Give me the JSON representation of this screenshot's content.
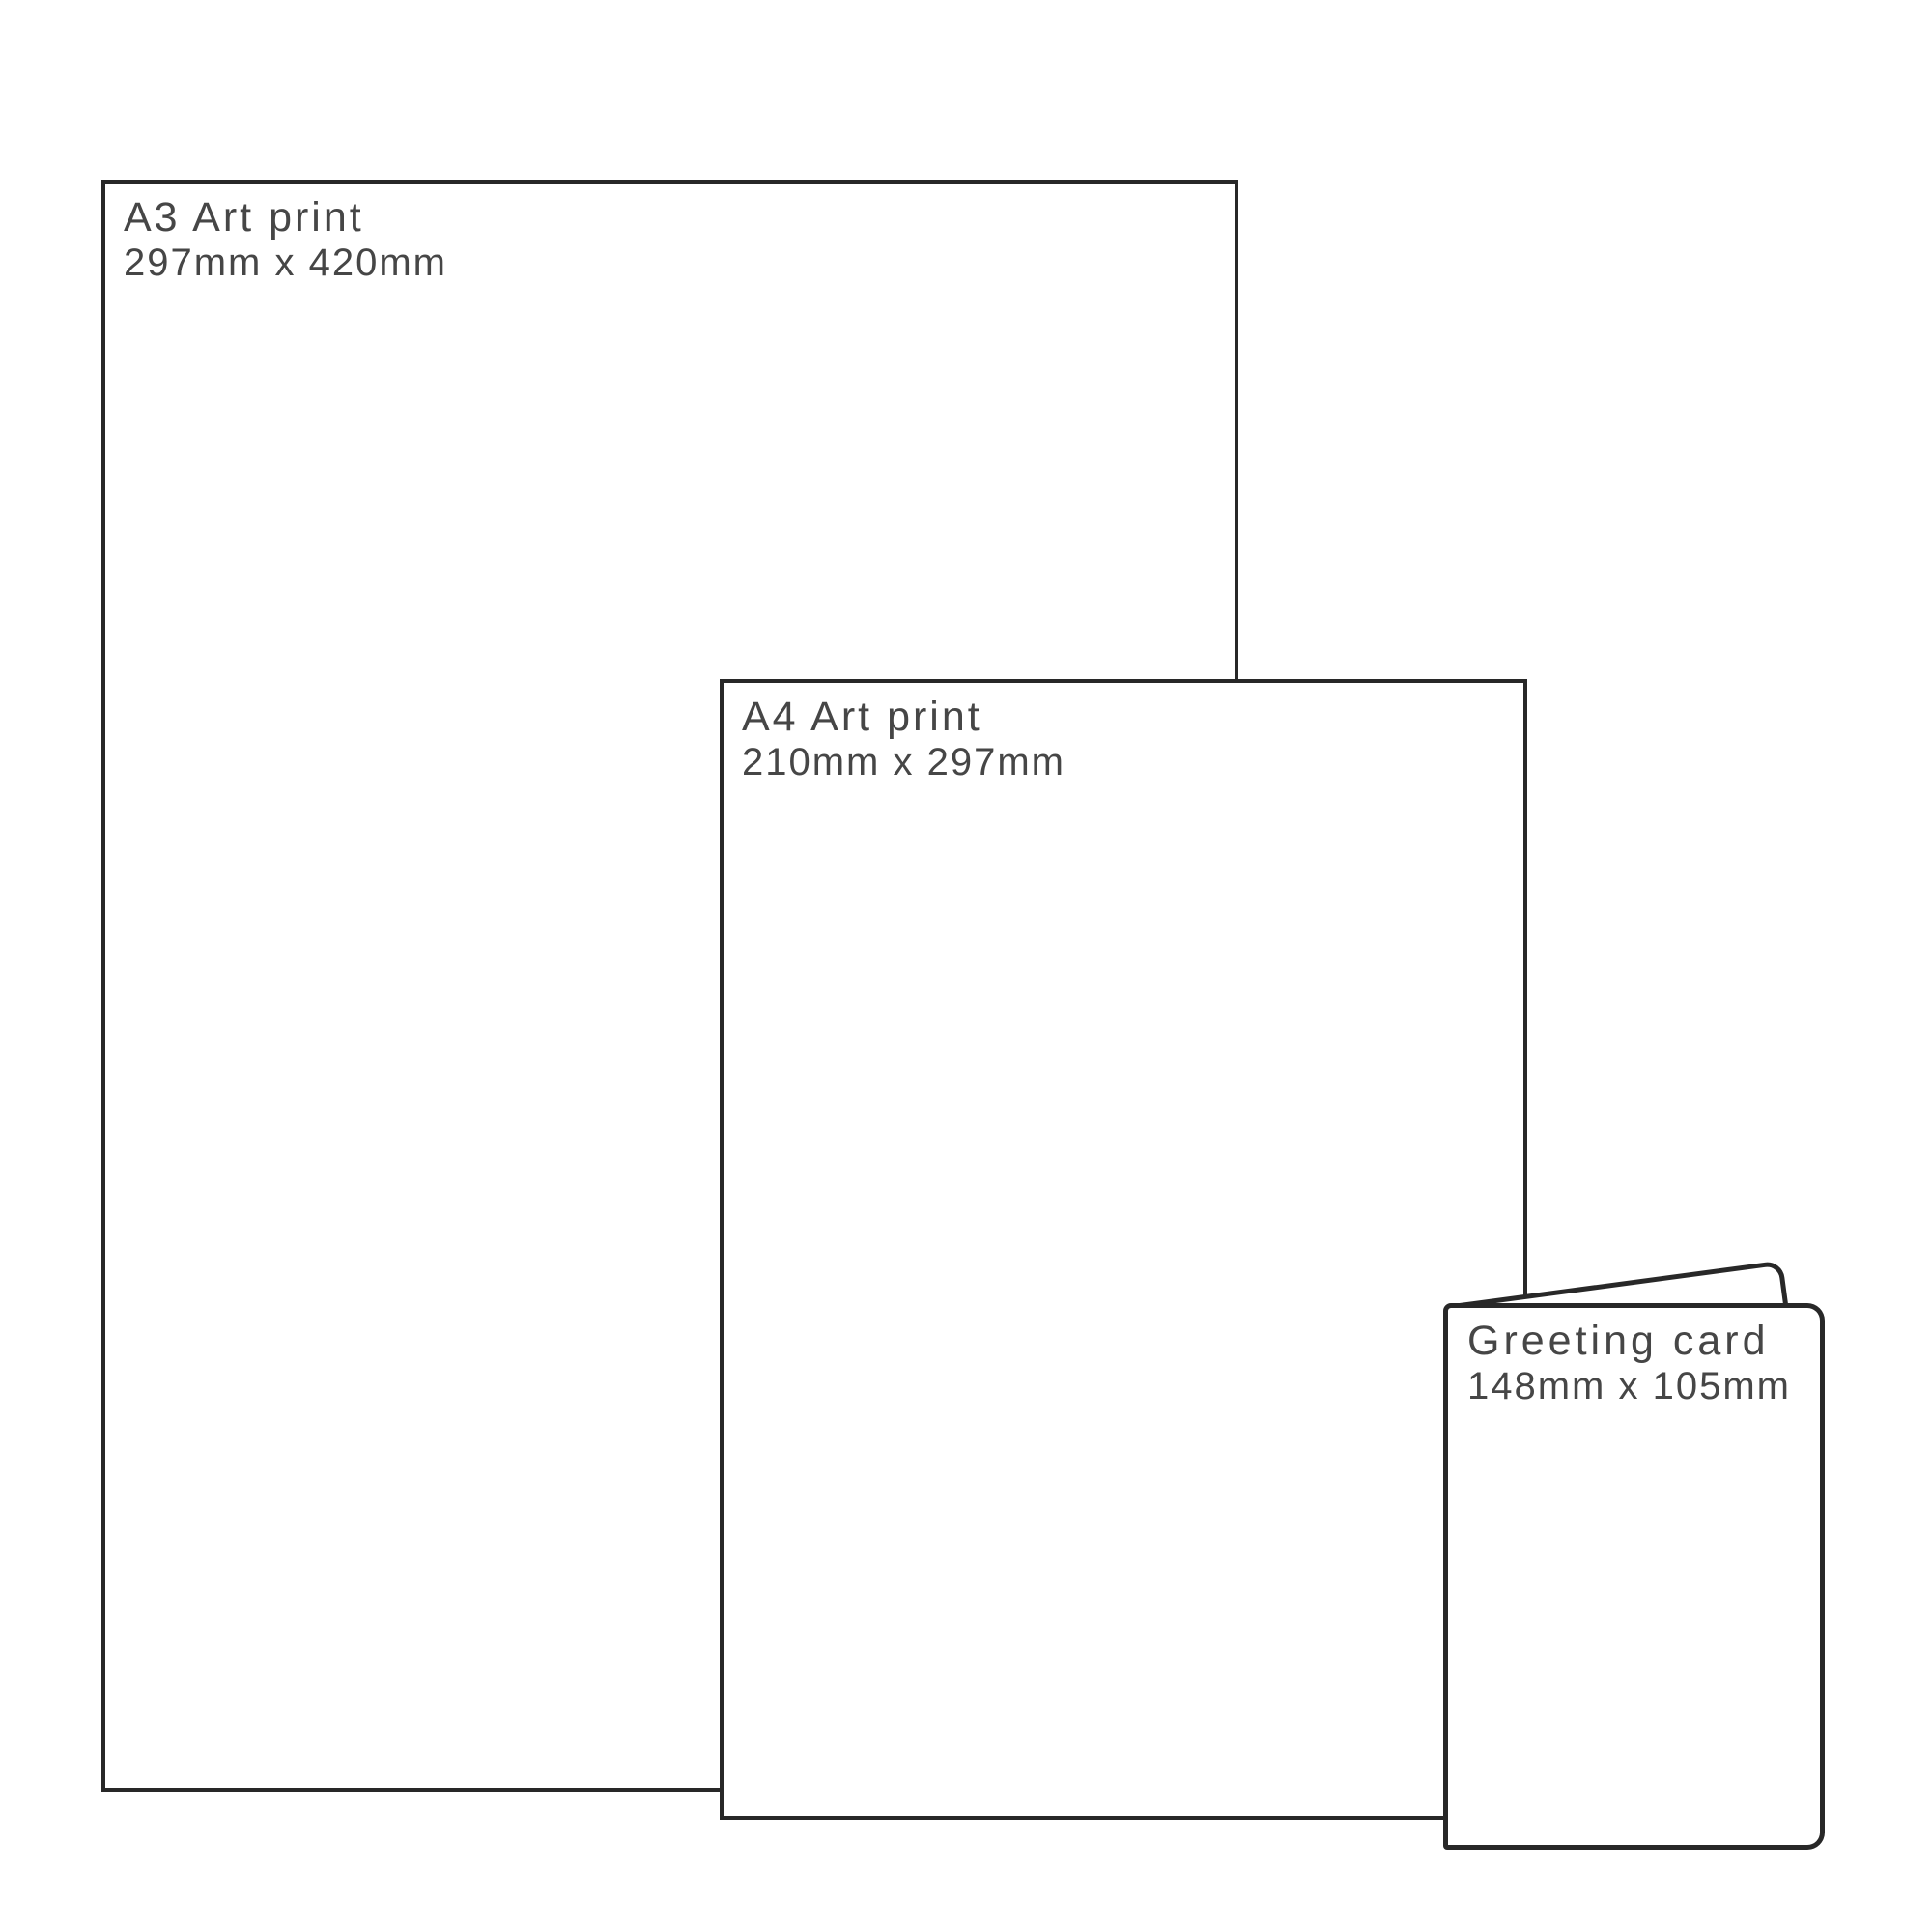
{
  "diagram": {
    "type": "print-size-comparison"
  },
  "colors": {
    "background": "#ffffff",
    "outline": "#282828",
    "text": "#464646"
  },
  "items": [
    {
      "id": "a3-art-print",
      "label": "A3 Art print",
      "dimensions": "297mm x 420mm"
    },
    {
      "id": "a4-art-print",
      "label": "A4 Art print",
      "dimensions": "210mm x 297mm"
    },
    {
      "id": "greeting-card",
      "label": "Greeting card",
      "dimensions": "148mm x 105mm"
    }
  ]
}
